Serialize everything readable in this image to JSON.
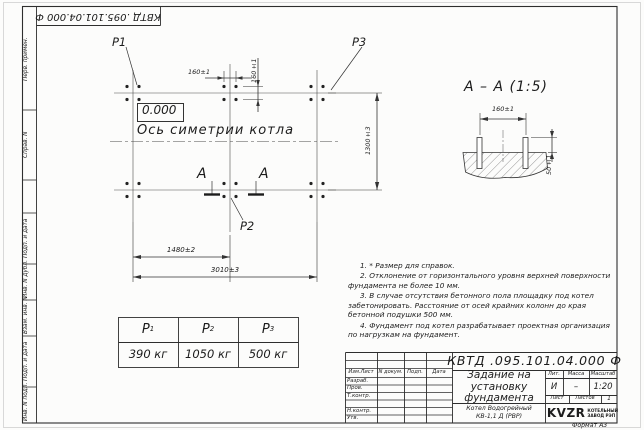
{
  "frame": {
    "stamp_top": "КВТД .095.101.04.000 Ф",
    "format_note": "Формат А3",
    "side_labels": [
      "Перв. примен.",
      "Справ. N",
      "Подп. и дата",
      "Инв. N дубл.",
      "Взам. инв. N",
      "Подп. и дата",
      "Инв. N подл."
    ]
  },
  "plan": {
    "point_labels": {
      "p1": "P1",
      "p2": "P2",
      "p3": "Р3"
    },
    "elevation": "0.000",
    "axis_caption": "Ось симетрии котла",
    "section_mark": "А",
    "dims": {
      "bolt_spacing_x": "160±1",
      "bolt_spacing_y": "160±1",
      "depth": "1300±3",
      "mid_span": "1480±2",
      "total_span": "3010±3"
    }
  },
  "section_view": {
    "title": "А – А (1:5)",
    "dims": {
      "spacing": "160±1",
      "protrusion": "50±1"
    }
  },
  "notes": [
    "1. * Размер для справок.",
    "2. Отклонение от горизонтального уровня верхней поверхности фундамента не более 10 мм.",
    "3. В случае отсутствия бетонного пола площадку под котел забетонировать. Расстояние от осей крайних колонн до края бетонной подушки 500 мм.",
    "4. Фундамент под котел разрабатывает проектная организация по нагрузкам на фундамент."
  ],
  "load_table": {
    "columns": [
      {
        "symbol": "P",
        "sub": "1",
        "value": "390 кг"
      },
      {
        "symbol": "P",
        "sub": "2",
        "value": "1050 кг"
      },
      {
        "symbol": "P",
        "sub": "3",
        "value": "500 кг"
      }
    ]
  },
  "title_block": {
    "doc_number": "КВТД .095.101.04.000 Ф",
    "doc_title": "Задание на установку фундамента",
    "product_line1": "Котел Водогрейный",
    "product_line2": "КВ-1,1 Д (РВР)",
    "change_cols": [
      "Изм.Лист",
      "N докум.",
      "Подп.",
      "Дата"
    ],
    "sign_rows": [
      "Разраб.",
      "Пров.",
      "Т.контр.",
      "",
      "Н.контр.",
      "Утв."
    ],
    "lit_label": "Лит.",
    "lit_value": "И",
    "mass_label": "Масса",
    "mass_value": "–",
    "scale_label": "Масштаб",
    "scale_value": "1:20",
    "sheet_label": "Лист",
    "sheets_label": "Листов",
    "sheets_value": "1",
    "logo_text": "KVZR",
    "logo_caption_line1": "КОТЕЛЬНЫЙ",
    "logo_caption_line2": "ЗАВОД РЭП"
  }
}
